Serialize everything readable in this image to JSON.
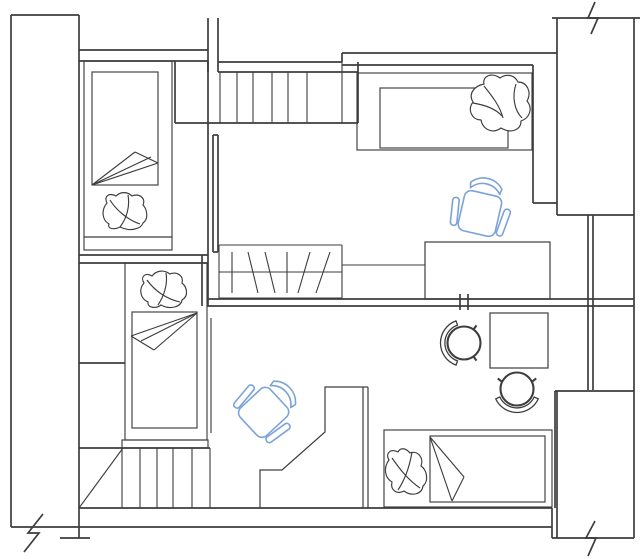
{
  "canvas": {
    "width": 640,
    "height": 559,
    "background": "#ffffff"
  },
  "colors": {
    "line": "#3d3d3d",
    "chair_accent": "#7ca3d8",
    "paper": "#ffffff"
  },
  "legend": {
    "drawing_type": "apartment floor plan, CAD line drawing, no text labels",
    "rooms": [
      "upper-left-bedroom",
      "upper-middle-room",
      "upper-right-bedroom",
      "lower-left-room",
      "lower-right-room"
    ],
    "furniture": [
      "bed-top-left",
      "bed-mid-left",
      "bed-top-right",
      "bed-bottom-right",
      "office-chair-blue x2",
      "round-chair x2",
      "square-table",
      "desk-upper-right",
      "angled-desk-lower",
      "staircase-upper",
      "staircase-lower",
      "hatched-wardrobe"
    ],
    "symbols": [
      "wall-break-zigzag x3",
      "double-line-walls",
      "window-strip-right"
    ]
  },
  "drawing": {
    "defaults": {
      "stroke": "#3d3d3d",
      "width": 1.2
    },
    "layers": [
      {
        "name": "walls",
        "item": "wall-line",
        "stroke": "#3d3d3d",
        "width": 1.7,
        "lines": [
          [
            11,
            15,
            11,
            527
          ],
          [
            79,
            15,
            79,
            538
          ],
          [
            11,
            15,
            79,
            15
          ],
          [
            79,
            50,
            208,
            50
          ],
          [
            79,
            61,
            208,
            61
          ],
          [
            208,
            18,
            208,
            72
          ],
          [
            218,
            18,
            218,
            72
          ],
          [
            218,
            62,
            342,
            62
          ],
          [
            342,
            53,
            342,
            62
          ],
          [
            342,
            53,
            557,
            53
          ],
          [
            342,
            65,
            533,
            65
          ],
          [
            533,
            65,
            533,
            203
          ],
          [
            533,
            203,
            557,
            203
          ],
          [
            552,
            18,
            640,
            18
          ],
          [
            557,
            18,
            557,
            215
          ],
          [
            634,
            18,
            634,
            538
          ],
          [
            557,
            215,
            634,
            215
          ],
          [
            588,
            215,
            588,
            390
          ],
          [
            593,
            215,
            593,
            390
          ],
          [
            555,
            391,
            634,
            391
          ],
          [
            557,
            391,
            557,
            538
          ],
          [
            552,
            538,
            634,
            538
          ],
          [
            555,
            391,
            555,
            508
          ],
          [
            207,
            299,
            634,
            299
          ],
          [
            207,
            306,
            634,
            306
          ],
          [
            460,
            294,
            460,
            310
          ],
          [
            468,
            294,
            468,
            310
          ],
          [
            79,
            255,
            208,
            255
          ],
          [
            79,
            263,
            208,
            263
          ],
          [
            202,
            255,
            202,
            306
          ],
          [
            208,
            61,
            208,
            306
          ],
          [
            213,
            135,
            213,
            252
          ],
          [
            218,
            135,
            218,
            252
          ],
          [
            213,
            135,
            218,
            135
          ],
          [
            213,
            252,
            218,
            252
          ],
          [
            175,
            61,
            175,
            123
          ],
          [
            175,
            123,
            358,
            123
          ],
          [
            218,
            72,
            358,
            72
          ],
          [
            358,
            62,
            358,
            123
          ],
          [
            79,
            363,
            125,
            363
          ],
          [
            79,
            448,
            210,
            448
          ],
          [
            79,
            508,
            552,
            508
          ],
          [
            11,
            527,
            552,
            527
          ],
          [
            60,
            538,
            90,
            538
          ],
          [
            552,
            508,
            552,
            538
          ]
        ],
        "polylines": [
          [
            [
              595,
              2
            ],
            [
              588,
              18
            ],
            [
              598,
              18
            ],
            [
              591,
              34
            ]
          ],
          [
            [
              43,
              514
            ],
            [
              28,
              533
            ],
            [
              39,
              533
            ],
            [
              24,
              552
            ]
          ],
          [
            [
              595,
              521
            ],
            [
              586,
              538
            ],
            [
              596,
              538
            ],
            [
              588,
              556
            ]
          ]
        ]
      },
      {
        "name": "staircase-upper",
        "item": "stair-tread",
        "width": 1.1,
        "lines": [
          [
            220,
            72,
            220,
            123
          ],
          [
            237,
            72,
            237,
            123
          ],
          [
            253,
            72,
            253,
            123
          ],
          [
            272,
            72,
            272,
            123
          ],
          [
            288,
            72,
            288,
            123
          ],
          [
            307,
            72,
            307,
            123
          ],
          [
            342,
            62,
            342,
            123
          ]
        ]
      },
      {
        "name": "staircase-lower",
        "item": "stair-tread",
        "width": 1.1,
        "lines": [
          [
            122,
            448,
            122,
            508
          ],
          [
            140,
            448,
            140,
            508
          ],
          [
            157,
            448,
            157,
            508
          ],
          [
            173,
            448,
            173,
            508
          ],
          [
            192,
            448,
            192,
            508
          ],
          [
            210,
            448,
            210,
            508
          ],
          [
            123,
            448,
            79,
            508
          ]
        ]
      },
      {
        "name": "hatched-wardrobe",
        "item": "wardrobe-line",
        "width": 1.1,
        "lines": [
          [
            219,
            245,
            342,
            245
          ],
          [
            219,
            298,
            342,
            298
          ],
          [
            219,
            245,
            219,
            298
          ],
          [
            342,
            245,
            342,
            298
          ],
          [
            219,
            272,
            342,
            272
          ],
          [
            232,
            252,
            232,
            293
          ],
          [
            248,
            252,
            258,
            293
          ],
          [
            265,
            252,
            275,
            293
          ],
          [
            287,
            252,
            287,
            293
          ],
          [
            310,
            252,
            298,
            293
          ],
          [
            330,
            252,
            316,
            293
          ],
          [
            342,
            265,
            425,
            265
          ]
        ]
      },
      {
        "name": "beds",
        "item": "bed-line",
        "width": 1.15,
        "rects": [
          [
            84,
            61,
            88,
            189
          ],
          [
            92,
            72,
            66,
            113
          ],
          [
            125,
            263,
            82,
            177
          ],
          [
            132,
            312,
            65,
            116
          ],
          [
            122,
            440,
            86,
            8
          ],
          [
            384,
            430,
            168,
            77
          ],
          [
            430,
            436,
            115,
            66
          ],
          [
            357,
            73,
            175,
            77
          ],
          [
            380,
            88,
            128,
            60
          ]
        ],
        "lines": [
          [
            84,
            237,
            172,
            237
          ],
          [
            92,
            185,
            135,
            152
          ],
          [
            135,
            152,
            158,
            163
          ],
          [
            158,
            163,
            92,
            185
          ],
          [
            92,
            185,
            151,
            157
          ],
          [
            211,
            318,
            211,
            433
          ],
          [
            197,
            313,
            131,
            336
          ],
          [
            131,
            336,
            154,
            350
          ],
          [
            154,
            350,
            197,
            313
          ],
          [
            197,
            313,
            141,
            341
          ],
          [
            430,
            437,
            464,
            477
          ],
          [
            464,
            477,
            452,
            501
          ],
          [
            452,
            501,
            430,
            437
          ]
        ]
      },
      {
        "name": "pillows",
        "item": "pillow-path",
        "width": 1.15,
        "paths": [
          {
            "d": "M 116,196 C 108,192 104,197 107,203 C 101,210 102,220 109,224 C 107,229 114,230 120,227 C 130,232 141,229 143,223 C 149,219 147,209 143,205 C 146,198 139,193 132,196 C 127,191 120,192 116,196 Z"
          },
          {
            "d": "M 110,200 C 116,210 128,220 140,224"
          },
          {
            "d": "M 128,195 C 130,206 127,218 120,227"
          },
          {
            "d": "M 152,276 C 145,272 140,277 144,283 C 138,290 141,299 148,302 C 147,308 156,309 161,305 C 170,310 181,307 182,300 C 189,296 187,287 182,283 C 184,276 177,271 170,274 C 163,269 156,271 152,276 Z"
          },
          {
            "d": "M 147,280 C 154,290 166,299 180,302"
          },
          {
            "d": "M 166,273 C 168,284 164,296 158,305"
          },
          {
            "d": "M 500,78 C 492,72 482,76 484,84 C 474,86 468,94 473,102 C 467,110 472,120 481,120 C 483,130 493,134 501,128 C 511,134 521,130 521,121 C 530,118 533,108 527,101 C 532,92 527,82 518,82 C 514,74 506,74 500,78 Z",
            "fill": "#ffffff"
          },
          {
            "d": "M 484,86 C 492,96 500,106 503,118"
          },
          {
            "d": "M 516,84 C 512,96 514,110 522,118"
          },
          {
            "d": "M 473,103 C 485,105 496,109 502,116"
          },
          {
            "d": "M 398,452 C 390,448 385,454 389,460 C 383,468 385,478 392,482 C 390,490 397,495 404,491 C 412,497 422,494 423,486 C 429,481 427,470 421,466 C 424,458 418,450 410,453 C 405,447 400,448 398,452 Z"
          },
          {
            "d": "M 392,458 C 399,468 408,480 420,488"
          },
          {
            "d": "M 412,452 C 410,464 406,478 398,490"
          }
        ]
      },
      {
        "name": "desks",
        "item": "desk-line",
        "width": 1.2,
        "rects": [
          [
            425,
            242,
            125,
            57
          ],
          [
            490,
            313,
            58,
            55
          ]
        ],
        "polylines": [
          [
            [
              260,
              508
            ],
            [
              260,
              470
            ],
            [
              282,
              470
            ],
            [
              325,
              432
            ],
            [
              325,
              387
            ],
            [
              363,
              387
            ],
            [
              363,
              508
            ]
          ]
        ],
        "lines": [
          [
            363,
            387,
            368,
            387
          ],
          [
            368,
            387,
            368,
            508
          ]
        ]
      },
      {
        "name": "round-chairs",
        "item": "round-chair",
        "width": 2.1,
        "circles": [
          [
            464,
            343,
            16.5
          ],
          [
            517,
            389,
            16.5
          ]
        ],
        "paths": [
          {
            "d": "M 456,365.1 A 23.5,23.5 0 0 1 456,320.9 L 457.5,325.1 A 19,19 0 0 0 457.5,360.9 Z",
            "fill": "#ffffff",
            "width": 1.3
          },
          {
            "d": "M 538.3,398.9 A 23.5,23.5 0 0 1 495.7,398.9 L 499.8,397 A 19,19 0 0 0 534.2,397 Z",
            "fill": "#ffffff",
            "width": 1.3
          }
        ],
        "lines": [
          [
            473.2,
            356.1,
            476.5,
            360.6
          ],
          [
            473.2,
            329.9,
            476.5,
            325.4
          ],
          [
            502.5,
            382.2,
            497.8,
            378.4
          ],
          [
            531.5,
            382.2,
            536.2,
            378.4
          ]
        ]
      }
    ],
    "office_chair": {
      "stroke": "#7ca3d8",
      "width": 1.6,
      "seat": {
        "x": -19,
        "y": -20,
        "w": 38,
        "h": 41,
        "rx": 7
      },
      "back": "M -16,-28 A 21 21 0 0 1 16,-28 L 15,-22.5 A 19 19 0 0 0 -15,-22.5 Z",
      "arms": [
        {
          "x": -28.5,
          "y": -13,
          "w": 6.5,
          "h": 28,
          "rx": 3,
          "rot": -7
        },
        {
          "x": 22,
          "y": -13,
          "w": 6.5,
          "h": 28,
          "rx": 3,
          "rot": 7
        }
      ],
      "instances": [
        {
          "name": "office-chair-upper-right",
          "x": 480,
          "y": 213,
          "rot": 13
        },
        {
          "name": "office-chair-lower-left",
          "x": 264,
          "y": 412,
          "rot": 47
        }
      ]
    }
  }
}
